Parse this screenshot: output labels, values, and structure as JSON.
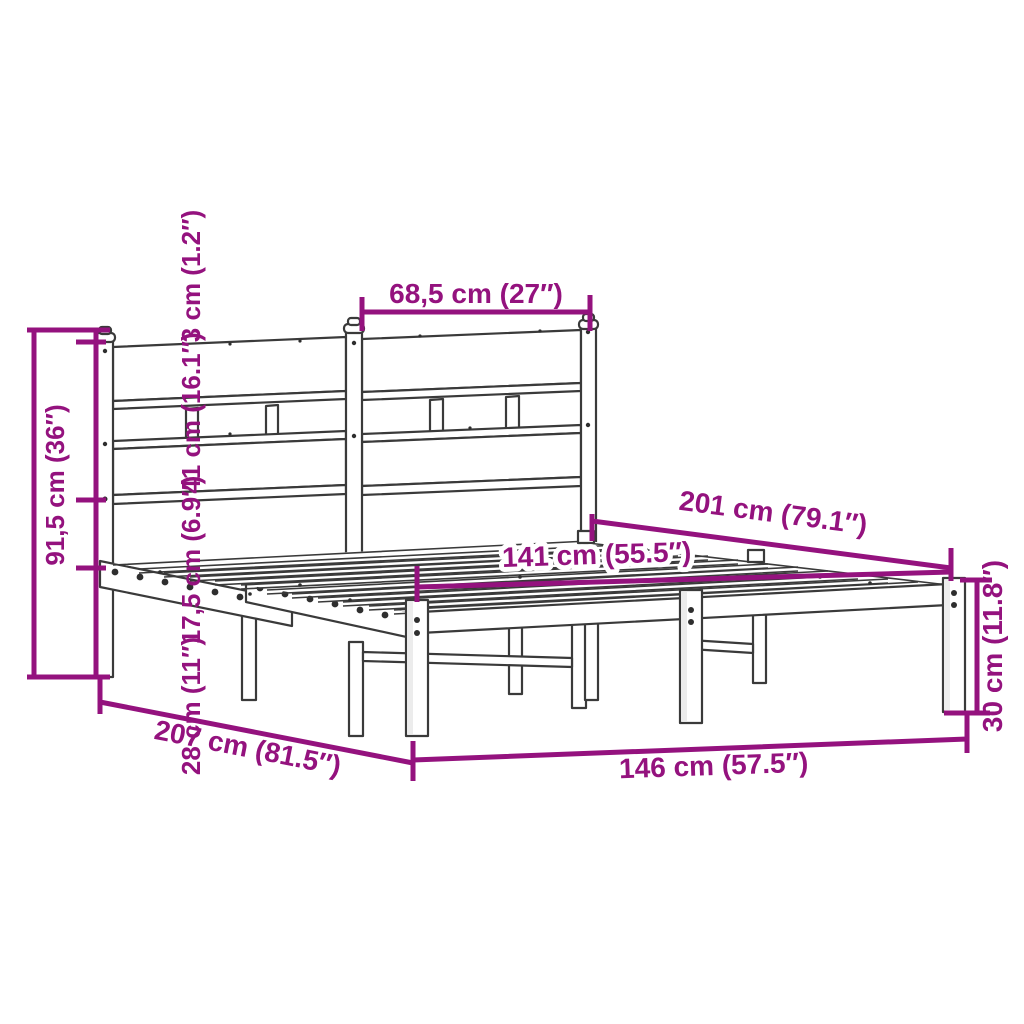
{
  "diagram": {
    "title": "Metal bed frame with headboard — dimension diagram",
    "product": "metal bed frame with headboard",
    "unit_style": "cm (inches)"
  },
  "colors": {
    "dimension_annotation": "#94127E",
    "drawing_outline": "#3A3A3A",
    "background": "#FFFFFF"
  },
  "dimensions": {
    "headboard_upper_section_width": "68,5 cm (27″)",
    "headboard_total_height": "91,5 cm (36″)",
    "headboard_top_cap_height": "3 cm (1.2″)",
    "headboard_panel_height": "41 cm (16.1″)",
    "headboard_to_frame_gap": "17,5 cm (6.9″)",
    "under_bed_clearance": "28 cm (11″)",
    "total_length": "207 cm (81.5″)",
    "total_width": "146 cm (57.5″)",
    "frame_length": "201 cm (79.1″)",
    "slat_area_width": "141 cm (55.5″)",
    "footend_frame_height": "30 cm (11.8″)"
  }
}
